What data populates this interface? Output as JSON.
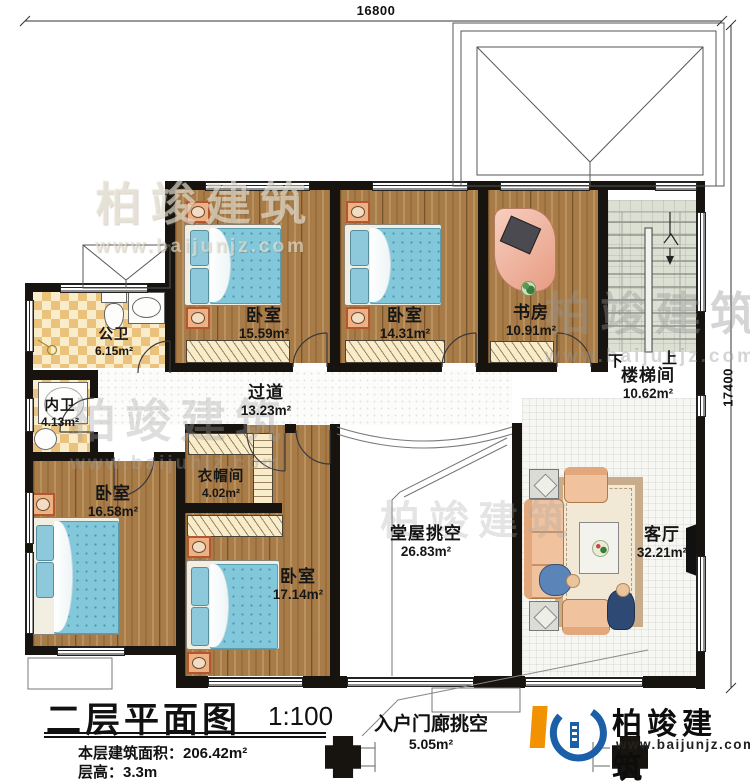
{
  "dimensions": {
    "top": "16800",
    "right": "17400"
  },
  "rooms": {
    "bedroom_tl": {
      "name": "卧室",
      "area": "15.59m²"
    },
    "bedroom_tm": {
      "name": "卧室",
      "area": "14.31m²"
    },
    "study": {
      "name": "书房",
      "area": "10.91m²"
    },
    "stairwell": {
      "name": "楼梯间",
      "area": "10.62m²"
    },
    "public_bath": {
      "name": "公卫",
      "area": "6.15m²"
    },
    "inner_bath": {
      "name": "内卫",
      "area": "4.13m²"
    },
    "corridor": {
      "name": "过道",
      "area": "13.23m²"
    },
    "cloakroom": {
      "name": "衣帽间",
      "area": "4.02m²"
    },
    "bedroom_bl": {
      "name": "卧室",
      "area": "16.58m²"
    },
    "bedroom_bm": {
      "name": "卧室",
      "area": "17.14m²"
    },
    "hall_void": {
      "name": "堂屋挑空",
      "area": "26.83m²"
    },
    "living": {
      "name": "客厅",
      "area": "32.21m²"
    },
    "porch_void": {
      "name": "入户门廊挑空",
      "area": "5.05m²"
    }
  },
  "stairs": {
    "down_label": "下",
    "up_label": "上"
  },
  "title_block": {
    "title": "二层平面图",
    "scale": "1:100",
    "floor_area": "本层建筑面积：206.42m²",
    "floor_height": "层高：3.3m"
  },
  "logo": {
    "name": "柏竣建筑",
    "website": "www.baijunjz.com"
  },
  "watermark": {
    "text": "柏竣建筑",
    "url": "www.baijunjz.com"
  },
  "colors": {
    "wall": "#17130e",
    "wood_floor": "#a87c48",
    "bed_blue": "#83c7da",
    "brand_orange": "#f39200",
    "brand_blue": "#1b5fa8"
  }
}
